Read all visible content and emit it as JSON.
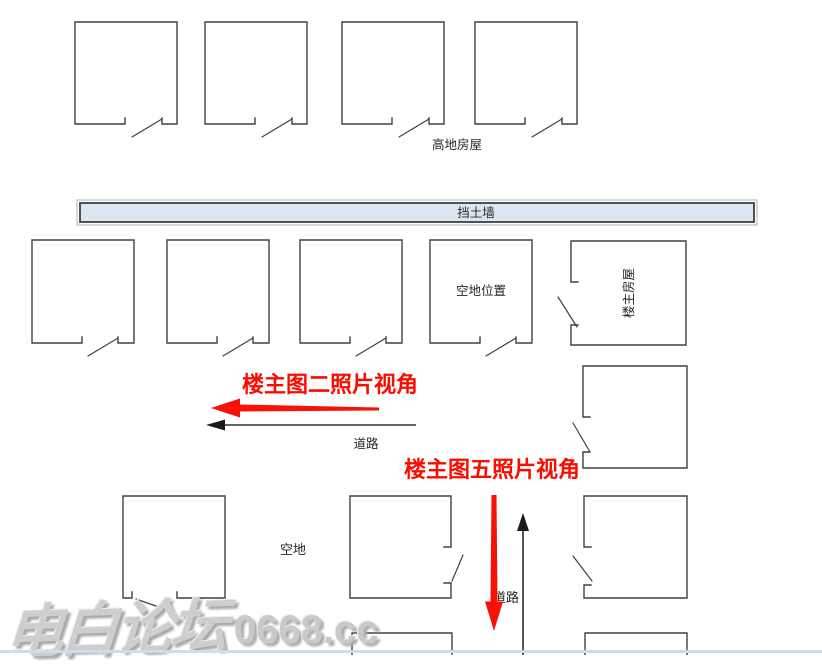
{
  "labels": {
    "highland_houses": "高地房屋",
    "retaining_wall": "挡土墙",
    "vacant_position": "空地位置",
    "owner_house": "楼主房屋",
    "road_upper": "道路",
    "road_lower": "道路",
    "vacant": "空地",
    "photo2_view": "楼主图二照片视角",
    "photo5_view": "楼主图五照片视角"
  },
  "watermark": {
    "cn": "电白论坛",
    "site": "0668.cc"
  },
  "colors": {
    "annotation_red": "#fb0c00",
    "diagram_line": "#404040",
    "wall_fill": "#dce6f1",
    "wall_border": "#3f3f3f",
    "label_text": "#262626",
    "watermark_gray": "#cecece",
    "bottom_edge_blue": "#cdddf0"
  }
}
